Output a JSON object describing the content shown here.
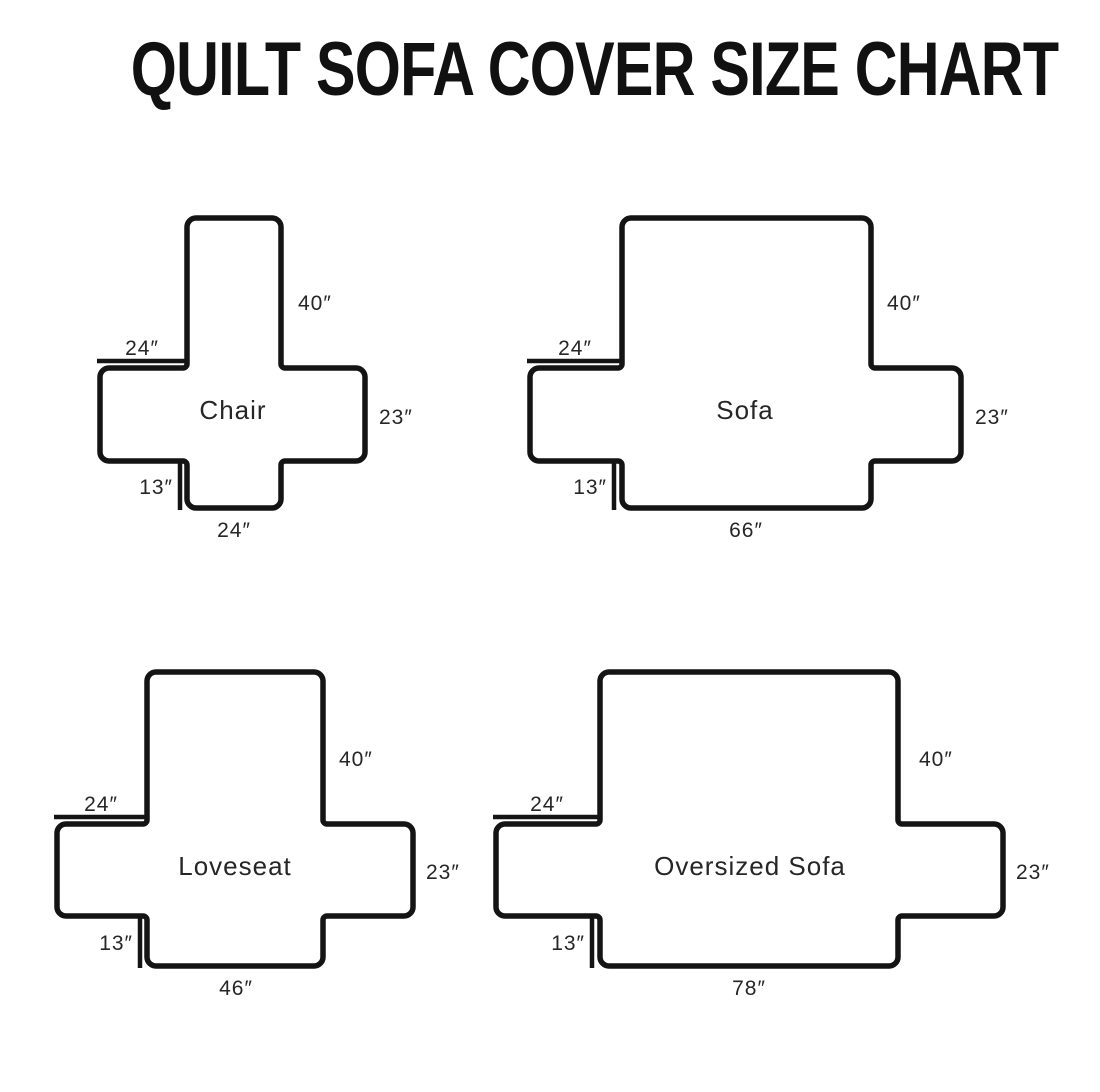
{
  "title": "QUILT SOFA COVER SIZE CHART",
  "colors": {
    "background": "#ffffff",
    "title": "#111111",
    "line": "#141414",
    "text": "#262626"
  },
  "shapes": [
    {
      "id": "chair",
      "name": "Chair",
      "dims": {
        "back_height": "40″",
        "arm_width": "24″",
        "side_height": "23″",
        "flap_height": "13″",
        "seat_width": "24″"
      }
    },
    {
      "id": "sofa",
      "name": "Sofa",
      "dims": {
        "back_height": "40″",
        "arm_width": "24″",
        "side_height": "23″",
        "flap_height": "13″",
        "seat_width": "66″"
      }
    },
    {
      "id": "loveseat",
      "name": "Loveseat",
      "dims": {
        "back_height": "40″",
        "arm_width": "24″",
        "side_height": "23″",
        "flap_height": "13″",
        "seat_width": "46″"
      }
    },
    {
      "id": "oversized-sofa",
      "name": "Oversized Sofa",
      "dims": {
        "back_height": "40″",
        "arm_width": "24″",
        "side_height": "23″",
        "flap_height": "13″",
        "seat_width": "78″"
      }
    }
  ]
}
